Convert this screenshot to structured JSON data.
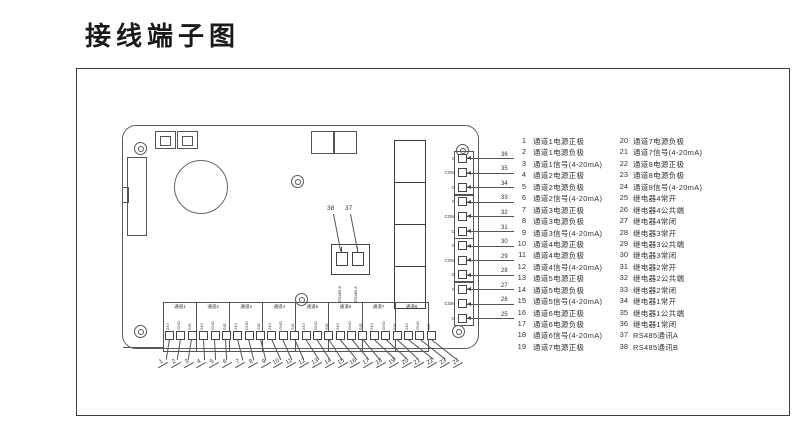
{
  "title": "接线端子图",
  "board": {
    "rs485": {
      "left_num": "38",
      "right_num": "37",
      "left_label": "RS485 B",
      "right_label": "RS485 A"
    },
    "relay_rows": [
      {
        "label": "C",
        "num": "36"
      },
      {
        "label": "COM",
        "num": "35"
      },
      {
        "label": "O",
        "num": "34"
      },
      {
        "label": "C",
        "num": "33"
      },
      {
        "label": "COM",
        "num": "32"
      },
      {
        "label": "O",
        "num": "31"
      },
      {
        "label": "C",
        "num": "30"
      },
      {
        "label": "COM",
        "num": "29"
      },
      {
        "label": "O",
        "num": "28"
      },
      {
        "label": "C",
        "num": "27"
      },
      {
        "label": "COM",
        "num": "26"
      },
      {
        "label": "O",
        "num": "25"
      }
    ],
    "channel_groups": [
      {
        "name": "通道1"
      },
      {
        "name": "通道2"
      },
      {
        "name": "通道3"
      },
      {
        "name": "通道4"
      },
      {
        "name": "通道5"
      },
      {
        "name": "通道6"
      },
      {
        "name": "通道7"
      },
      {
        "name": "通道8"
      }
    ],
    "channel_cols": [
      {
        "label": "24V",
        "num": "1"
      },
      {
        "label": "GND",
        "num": "2"
      },
      {
        "label": "SIG",
        "num": "3"
      },
      {
        "label": "24V",
        "num": "4"
      },
      {
        "label": "GND",
        "num": "5"
      },
      {
        "label": "SIG",
        "num": "6"
      },
      {
        "label": "24V",
        "num": "7"
      },
      {
        "label": "GND",
        "num": "8"
      },
      {
        "label": "SIG",
        "num": "9"
      },
      {
        "label": "24V",
        "num": "10"
      },
      {
        "label": "GND",
        "num": "11"
      },
      {
        "label": "SIG",
        "num": "12"
      },
      {
        "label": "24V",
        "num": "13"
      },
      {
        "label": "GND",
        "num": "14"
      },
      {
        "label": "SIG",
        "num": "15"
      },
      {
        "label": "24V",
        "num": "16"
      },
      {
        "label": "GND",
        "num": "17"
      },
      {
        "label": "SIG",
        "num": "18"
      },
      {
        "label": "24V",
        "num": "19"
      },
      {
        "label": "GND",
        "num": "20"
      },
      {
        "label": "SIG",
        "num": "21"
      },
      {
        "label": "24V",
        "num": "22"
      },
      {
        "label": "GND",
        "num": "23"
      },
      {
        "label": "SIG",
        "num": "24"
      }
    ]
  },
  "legend": {
    "left": [
      {
        "num": "1",
        "text": "通道1电源正极"
      },
      {
        "num": "2",
        "text": "通道1电源负极"
      },
      {
        "num": "3",
        "text": "通道1信号(4-20mA)"
      },
      {
        "num": "4",
        "text": "通道2电源正极"
      },
      {
        "num": "5",
        "text": "通道2电源负极"
      },
      {
        "num": "6",
        "text": "通道2信号(4-20mA)"
      },
      {
        "num": "7",
        "text": "通道3电源正极"
      },
      {
        "num": "8",
        "text": "通道3电源负极"
      },
      {
        "num": "9",
        "text": "通道3信号(4-20mA)"
      },
      {
        "num": "10",
        "text": "通道4电源正极"
      },
      {
        "num": "11",
        "text": "通道4电源负极"
      },
      {
        "num": "12",
        "text": "通道4信号(4-20mA)"
      },
      {
        "num": "13",
        "text": "通道5电源正极"
      },
      {
        "num": "14",
        "text": "通道5电源负极"
      },
      {
        "num": "15",
        "text": "通道5信号(4-20mA)"
      },
      {
        "num": "16",
        "text": "通道6电源正极"
      },
      {
        "num": "17",
        "text": "通道6电源负极"
      },
      {
        "num": "18",
        "text": "通道6信号(4-20mA)"
      },
      {
        "num": "19",
        "text": "通道7电源正极"
      }
    ],
    "right": [
      {
        "num": "20",
        "text": "通道7电源负极"
      },
      {
        "num": "21",
        "text": "通道7信号(4-20mA)"
      },
      {
        "num": "22",
        "text": "通道8电源正极"
      },
      {
        "num": "23",
        "text": "通道8电源负极"
      },
      {
        "num": "24",
        "text": "通道8信号(4-20mA)"
      },
      {
        "num": "25",
        "text": "继电器4常开"
      },
      {
        "num": "26",
        "text": "继电器4公共端"
      },
      {
        "num": "27",
        "text": "继电器4常闭"
      },
      {
        "num": "28",
        "text": "继电器3常开"
      },
      {
        "num": "29",
        "text": "继电器3公共端"
      },
      {
        "num": "30",
        "text": "继电器3常闭"
      },
      {
        "num": "31",
        "text": "继电器2常开"
      },
      {
        "num": "32",
        "text": "继电器2公共端"
      },
      {
        "num": "33",
        "text": "继电器2常闭"
      },
      {
        "num": "34",
        "text": "继电器1常开"
      },
      {
        "num": "35",
        "text": "继电器1公共端"
      },
      {
        "num": "36",
        "text": "继电器1常闭"
      },
      {
        "num": "37",
        "text": "RS485通讯A"
      },
      {
        "num": "38",
        "text": "RS485通讯B"
      }
    ]
  }
}
